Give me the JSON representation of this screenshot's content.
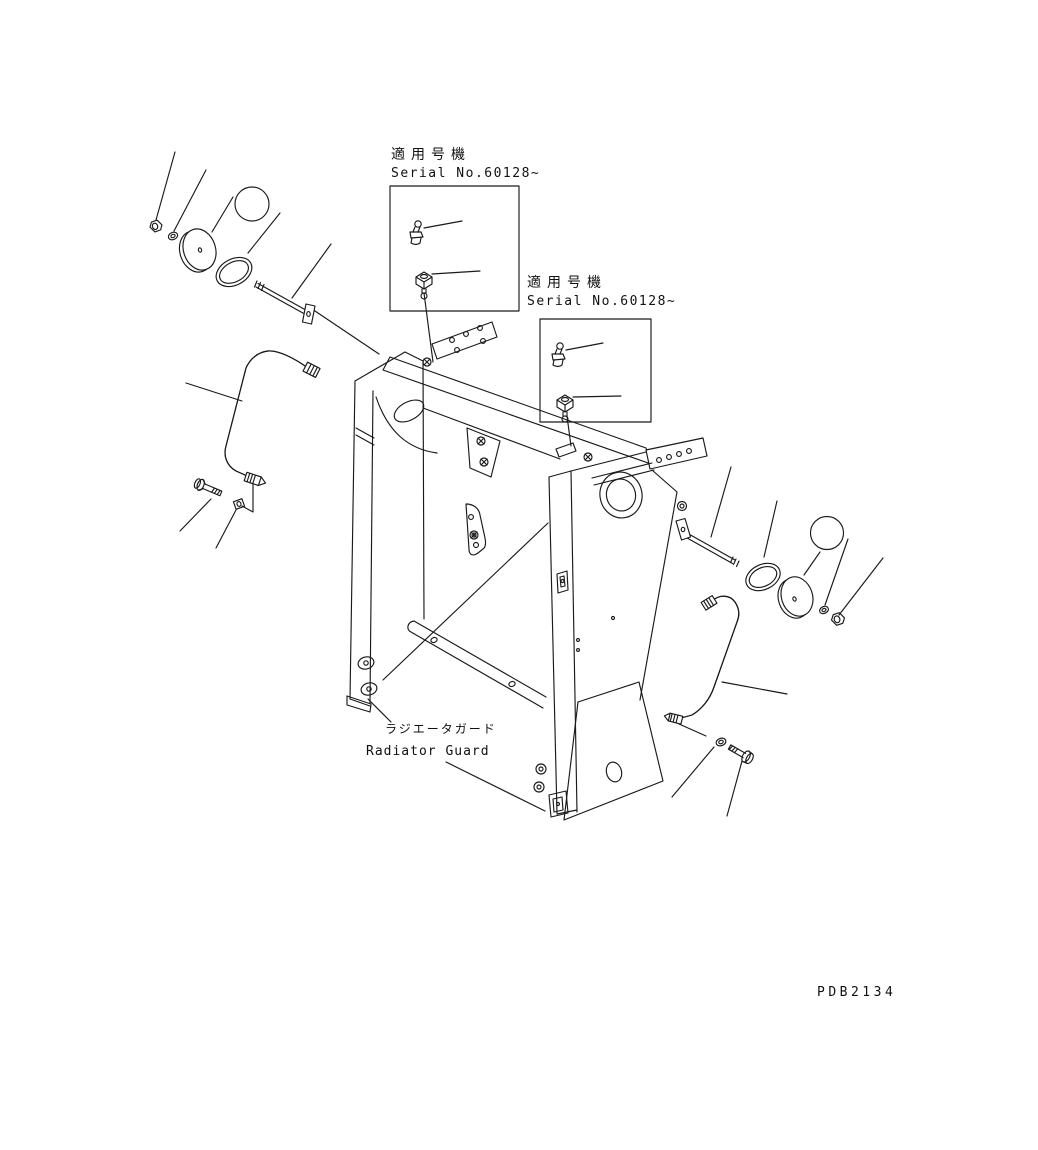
{
  "diagram": {
    "background": "#ffffff",
    "line_color": "#1a1a1a",
    "drawing_code": "PDB2134",
    "serial_notes": [
      {
        "title": "適用号機",
        "serial": "Serial No.60128~"
      },
      {
        "title": "適用号機",
        "serial": "Serial No.60128~"
      }
    ],
    "part_label": {
      "jp": "ラジエータガード",
      "en": "Radiator Guard"
    },
    "callouts": [
      {
        "number": "5",
        "fill": "#1a7d1a",
        "ring_color": "#000000",
        "text_color": "#ffffff"
      },
      {
        "number": "5",
        "fill": "#1a7d1a",
        "ring_color": "#000000",
        "text_color": "#ffffff"
      }
    ]
  }
}
